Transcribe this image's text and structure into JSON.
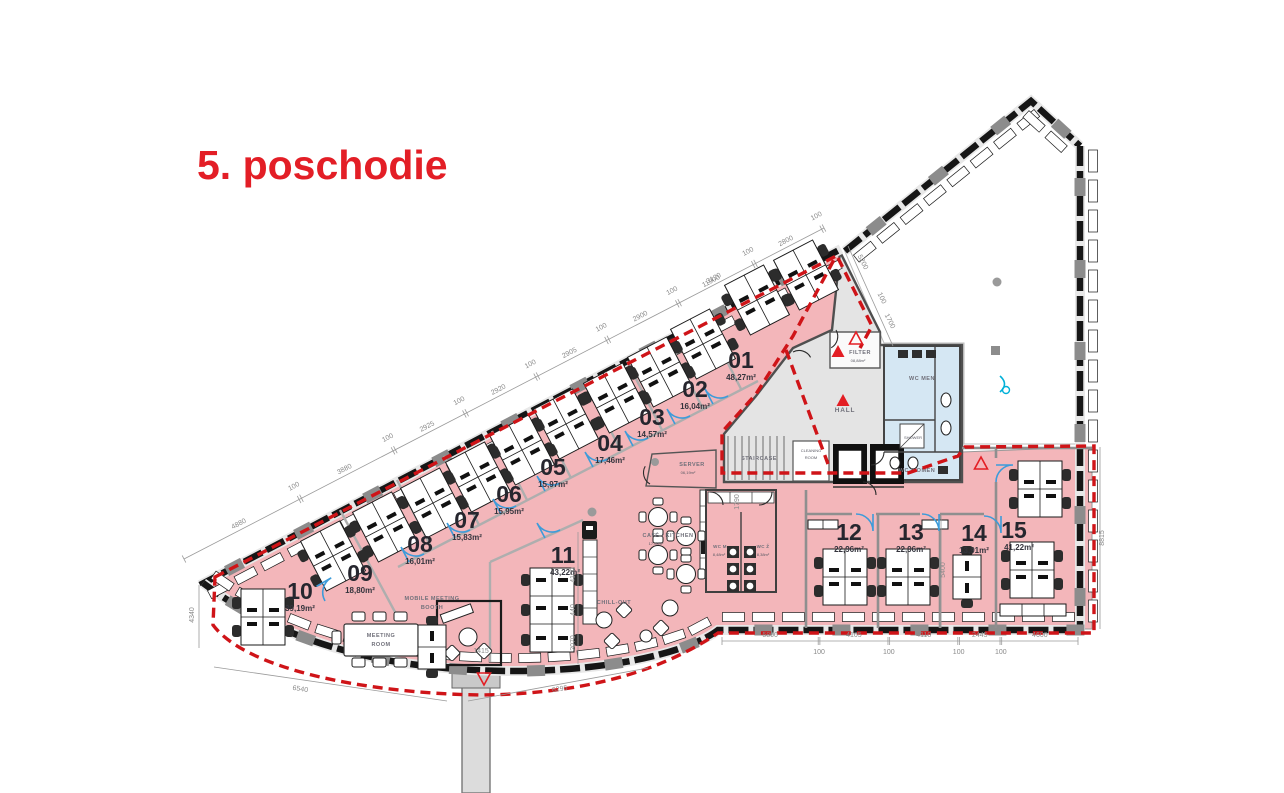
{
  "title": "5. poschodie",
  "colors": {
    "accent_red": "#e31e26",
    "plan_pink": "#f3b6ba",
    "core_gray": "#e4e4e4",
    "wc_blue": "#d5e7f3",
    "boundary_red": "#cf1418",
    "door_blue": "#3d9bd9"
  },
  "rooms": [
    {
      "number": "01",
      "area": "48,27m²"
    },
    {
      "number": "02",
      "area": "16,04m²"
    },
    {
      "number": "03",
      "area": "14,57m²"
    },
    {
      "number": "04",
      "area": "17,46m²"
    },
    {
      "number": "05",
      "area": "15,97m²"
    },
    {
      "number": "06",
      "area": "15,95m²"
    },
    {
      "number": "07",
      "area": "15,83m²"
    },
    {
      "number": "08",
      "area": "16,01m²"
    },
    {
      "number": "09",
      "area": "18,80m²"
    },
    {
      "number": "10",
      "area": "39,19m²"
    },
    {
      "number": "11",
      "area": "43,22m²"
    },
    {
      "number": "12",
      "area": "22,96m²"
    },
    {
      "number": "13",
      "area": "22,96m²"
    },
    {
      "number": "14",
      "area": "13,91m²"
    },
    {
      "number": "15",
      "area": "41,22m²"
    }
  ],
  "spaces": {
    "server": {
      "name": "SERVER",
      "area": "06,19m²"
    },
    "cafe": {
      "name": "CAFÉ / KITCHEN",
      "area": "17,08m²"
    },
    "wc_m": {
      "name": "WC M",
      "area": "8,48m²"
    },
    "wc_z": {
      "name": "WC Ž",
      "area": "8,38m²"
    },
    "filter": {
      "name": "FILTER",
      "area": "08,88m²"
    },
    "hall": {
      "name": "HALL"
    },
    "staircase": {
      "name": "STAIRCASE"
    },
    "cleaning": {
      "line1": "CLEANING",
      "line2": "ROOM"
    },
    "wc_men": {
      "name": "WC MEN"
    },
    "wc_women": {
      "name": "WC WOMEN"
    },
    "shower": {
      "name": "SHOWER"
    },
    "meeting": {
      "line1": "MEETING",
      "line2": "ROOM"
    },
    "booth": {
      "line1": "MOBILE MEETING",
      "line2": "BOOTH"
    },
    "chill": {
      "name": "CHILL-OUT"
    }
  },
  "dimensions": {
    "top_chain": [
      "4880",
      "100",
      "3880",
      "100",
      "2925",
      "100",
      "2920",
      "100",
      "2905",
      "100",
      "2900",
      "100",
      "3120",
      "100",
      "2800",
      "100"
    ],
    "bottom_chain": [
      "5800",
      "100",
      "4105",
      "100",
      "4110",
      "100",
      "2445",
      "100",
      "4600"
    ],
    "labels": {
      "d11900": "11900",
      "d5200": "5200",
      "d100b": "100",
      "d1700": "1700",
      "d8815": "8815",
      "d4340": "4340",
      "d6540": "6540",
      "d6295": "6295",
      "d1415": "1415",
      "d4100": "4100",
      "d440": "440",
      "d2070": "2070",
      "d5400": "5400",
      "d1790": "1790"
    }
  }
}
